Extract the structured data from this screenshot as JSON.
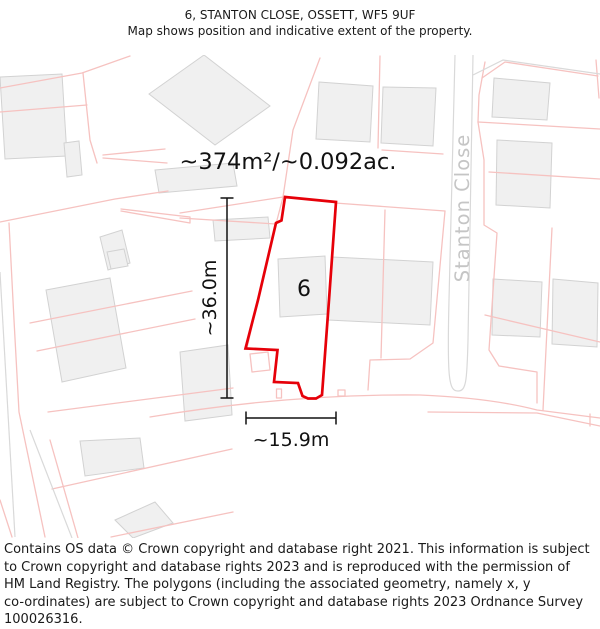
{
  "title": {
    "line1": "6, STANTON CLOSE, OSSETT, WF5 9UF",
    "line2": "Map shows position and indicative extent of the property."
  },
  "map": {
    "area_label": "~374m²/~0.092ac.",
    "plot_number": "6",
    "street_name": "Stanton Close",
    "dimensions": {
      "height": "~36.0m",
      "width": "~15.9m"
    },
    "colors": {
      "property_outline": "#e60009",
      "parcel_line": "#f6c2c0",
      "building_fill": "#f0f0f0",
      "building_stroke": "#d2d2d2",
      "road_line": "#d9d9d9",
      "street_text": "#c5c5c5",
      "dimension_line": "#111111"
    }
  },
  "footer": {
    "lines": [
      "Contains OS data © Crown copyright and database right 2021. This information is subject",
      "to Crown copyright and database rights 2023 and is reproduced with the permission of",
      "HM Land Registry. The polygons (including the associated geometry, namely x, y",
      "co-ordinates) are subject to Crown copyright and database rights 2023 Ordnance Survey",
      "100026316."
    ]
  }
}
